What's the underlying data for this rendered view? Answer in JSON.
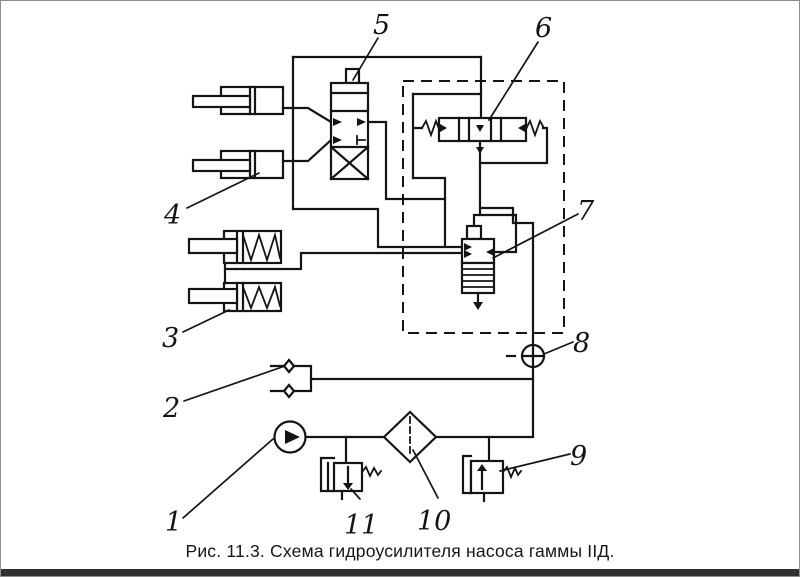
{
  "figure": {
    "caption": "Рис. 11.3. Схема гидроусилителя насоса гаммы IIД.",
    "labels": [
      "1",
      "2",
      "3",
      "4",
      "5",
      "6",
      "7",
      "8",
      "9",
      "10",
      "11"
    ],
    "legend": {
      "1": "pump",
      "2": "check-fittings",
      "3": "spring-loaded-cylinders",
      "4": "hydraulic-cylinders",
      "5": "directional-control-valve",
      "6": "spool-valve",
      "7": "pressure-valve",
      "8": "orifice-gauge",
      "9": "relief-valve-right",
      "10": "filter",
      "11": "relief-valve-left"
    },
    "colors": {
      "ink": "#141414",
      "background": "#ffffff",
      "frame": "#8e8e8e",
      "bottom_bar": "#303030"
    }
  }
}
